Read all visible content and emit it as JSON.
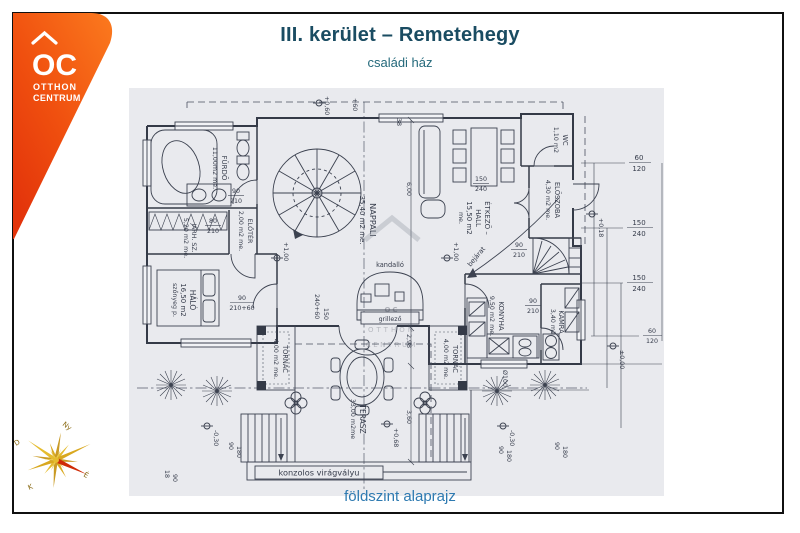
{
  "header": {
    "title": "III. kerület – Remetehegy",
    "subtitle": "családi ház"
  },
  "footer": {
    "caption": "földszint alaprajz"
  },
  "brand": {
    "logo_oc": "OC",
    "logo_line1": "OTTHON",
    "logo_line2": "CENTRUM"
  },
  "watermark": {
    "oc": "OC",
    "line1": "OTTHON",
    "line2": "CENTRUM"
  },
  "compass": {
    "north": "É",
    "south": "D",
    "east": "K",
    "west": "Ny"
  },
  "plan": {
    "rooms": {
      "furdo": {
        "name": "FÜRDŐ",
        "area": "11,00m2 me."
      },
      "eloter": {
        "name": "ELŐTÉR",
        "area": "2,00 m2 me."
      },
      "jarhsz": {
        "name": "JÁRH. SZ.",
        "area": "5,20 m2 me."
      },
      "halo": {
        "name": "HÁLÓ",
        "area": "16,50 m2",
        "note": "szőnyeg p."
      },
      "nappali": {
        "name": "NAPPALI",
        "area": "35,40 m2 me."
      },
      "etkezo": {
        "name": "ÉTKEZŐ –",
        "name2": "HALL",
        "area": "15,50 m2",
        "note": "me."
      },
      "wc": {
        "name": "WC",
        "area": "1,10 m2"
      },
      "eloszoba": {
        "name": "ELŐSZOBA",
        "area": "4,30 m2 me."
      },
      "konyha": {
        "name": "KONYHA",
        "area": "9,50 m2 me."
      },
      "kamra": {
        "name": "KAMRA",
        "area": "3,40 m2"
      },
      "tornac": {
        "name": "TORNÁC",
        "area": "4,00 m2 me."
      },
      "terasz": {
        "name": "TERASZ",
        "area": "33,00 m2me"
      }
    },
    "features": {
      "kandallo": "kandalló",
      "grillezo": "grillező",
      "viragvalyu": "konzolos virágvályu",
      "bejarat": "bejárat"
    },
    "levels": {
      "p060": "+0,60",
      "p100": "+1,00",
      "p000": "±0,00",
      "p018": "+0,18",
      "p068": "+0,68",
      "m030": "-0,30"
    },
    "dims": {
      "n18": "18",
      "n38": "38",
      "n60": "60",
      "n90": "90",
      "n120": "120",
      "n150": "150",
      "n180": "180",
      "n210": "210",
      "n240": "240",
      "n210p60": "210+60",
      "n240p60": "240+60",
      "n80": "80",
      "np60": "+60",
      "n298": "2,98",
      "n360": "3,60",
      "n600": "6,00",
      "nphi100": "Ø100"
    }
  }
}
